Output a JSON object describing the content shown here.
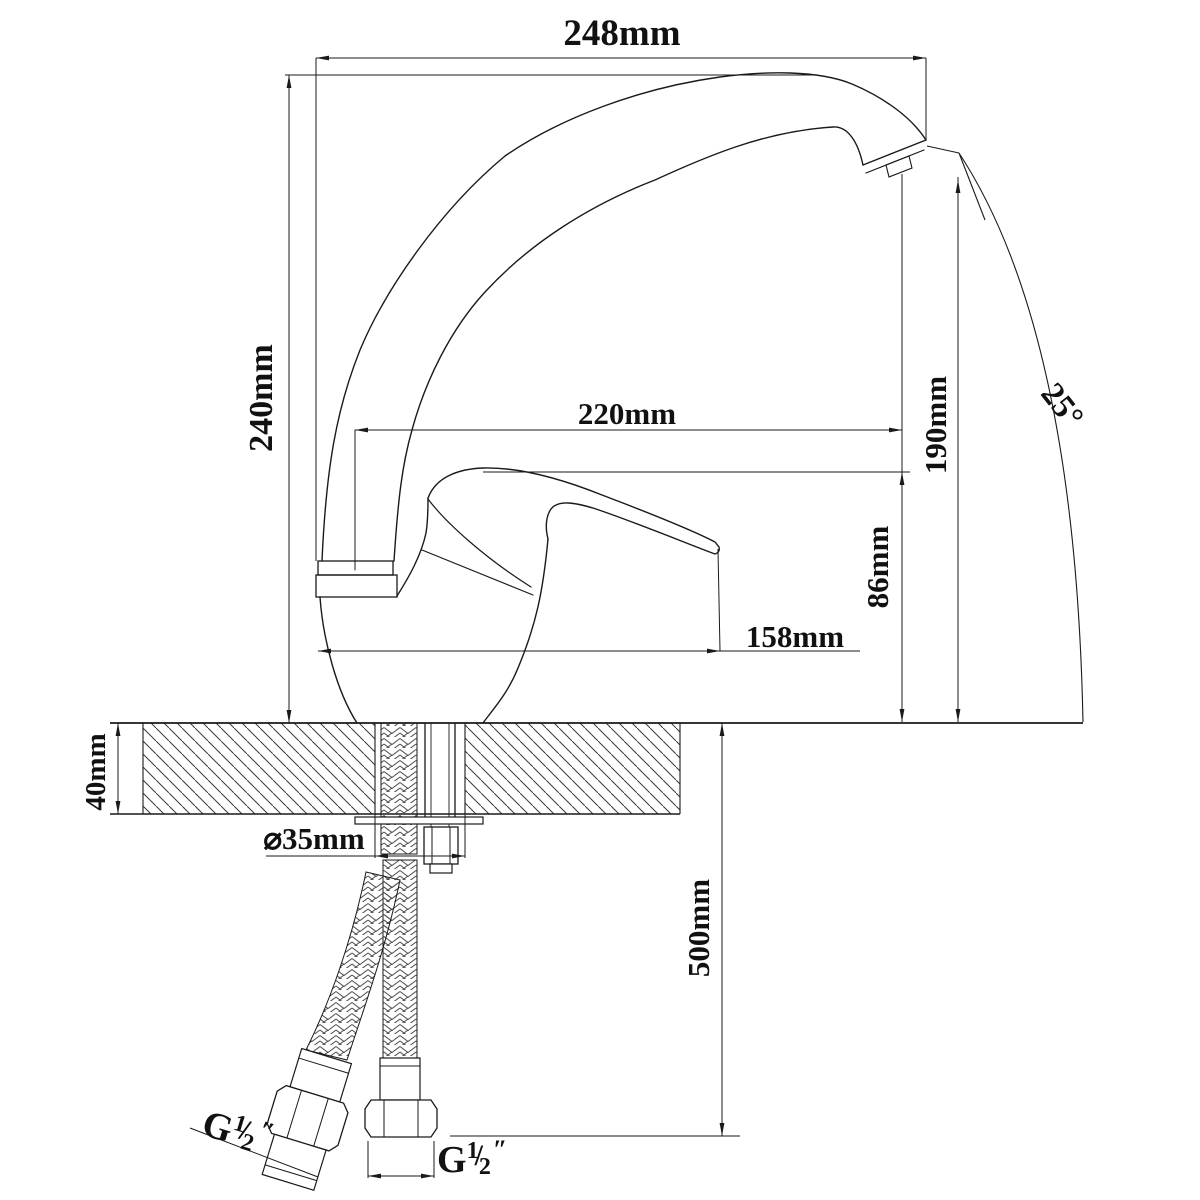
{
  "drawing": {
    "title": "Kitchen faucet dimensional drawing",
    "type": "technical-dimension-drawing",
    "subject": "single-lever swivel-spout kitchen mixer tap, side elevation with countertop cross-section and supply hoses",
    "colors": {
      "line": "#1a1a1a",
      "background": "#ffffff",
      "hatch": "#3a3a3a"
    },
    "dimensions": {
      "overall_reach": "248mm",
      "overall_height": "240mm",
      "spout_reach": "220mm",
      "outlet_height": "190mm",
      "body_height": "86mm",
      "handle_reach": "158mm",
      "swivel_angle": "25°",
      "counter_thickness": "40mm",
      "hole_diameter": "⌀35mm",
      "hose_length": "500mm",
      "left_thread": {
        "g": "G",
        "num": "1",
        "slash": "/",
        "den": "2",
        "unit": "″"
      },
      "right_thread": {
        "g": "G",
        "num": "1",
        "slash": "/",
        "den": "2",
        "unit": "″"
      }
    }
  }
}
